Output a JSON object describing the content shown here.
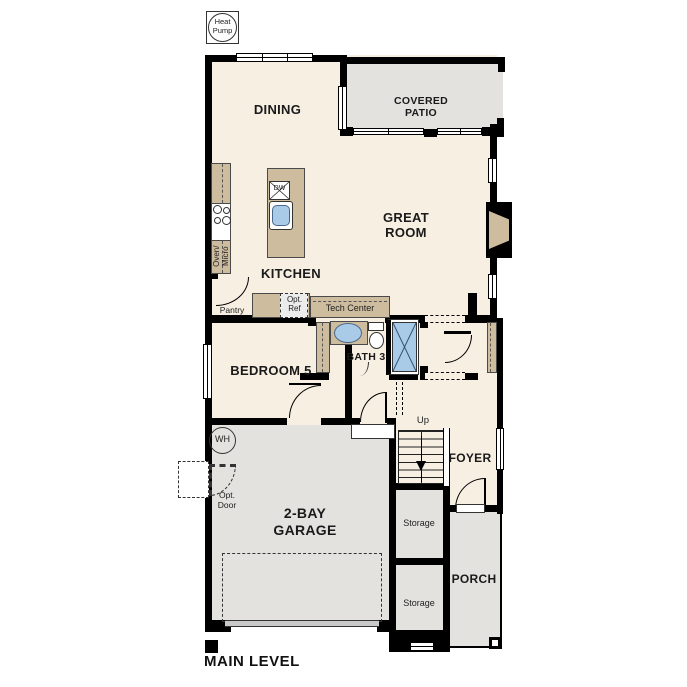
{
  "plan_title": "MAIN LEVEL",
  "rooms": {
    "dining": "DINING",
    "covered_patio": "COVERED\nPATIO",
    "great_room": "GREAT\nROOM",
    "kitchen": "KITCHEN",
    "bedroom5": "BEDROOM 5",
    "bath3": "BATH 3",
    "foyer": "FOYER",
    "garage": "2-BAY\nGARAGE",
    "porch": "PORCH",
    "storage_upper": "Storage",
    "storage_lower": "Storage"
  },
  "annotations": {
    "heat_pump": "Heat\nPump",
    "pantry": "Pantry",
    "opt_ref": "Opt.\nRef",
    "tech_center": "Tech Center",
    "oven_micro": "Oven/\nMicro",
    "dw": "DW",
    "up": "Up",
    "wh": "WH",
    "opt_door": "Opt.\nDoor"
  },
  "colors": {
    "interior_floor": "#f7efe2",
    "outdoor_floor": "#e3e2df",
    "counter_tan": "#cdbc9e",
    "fixture_blue": "#a9cbe8",
    "wall_black": "#000000"
  }
}
